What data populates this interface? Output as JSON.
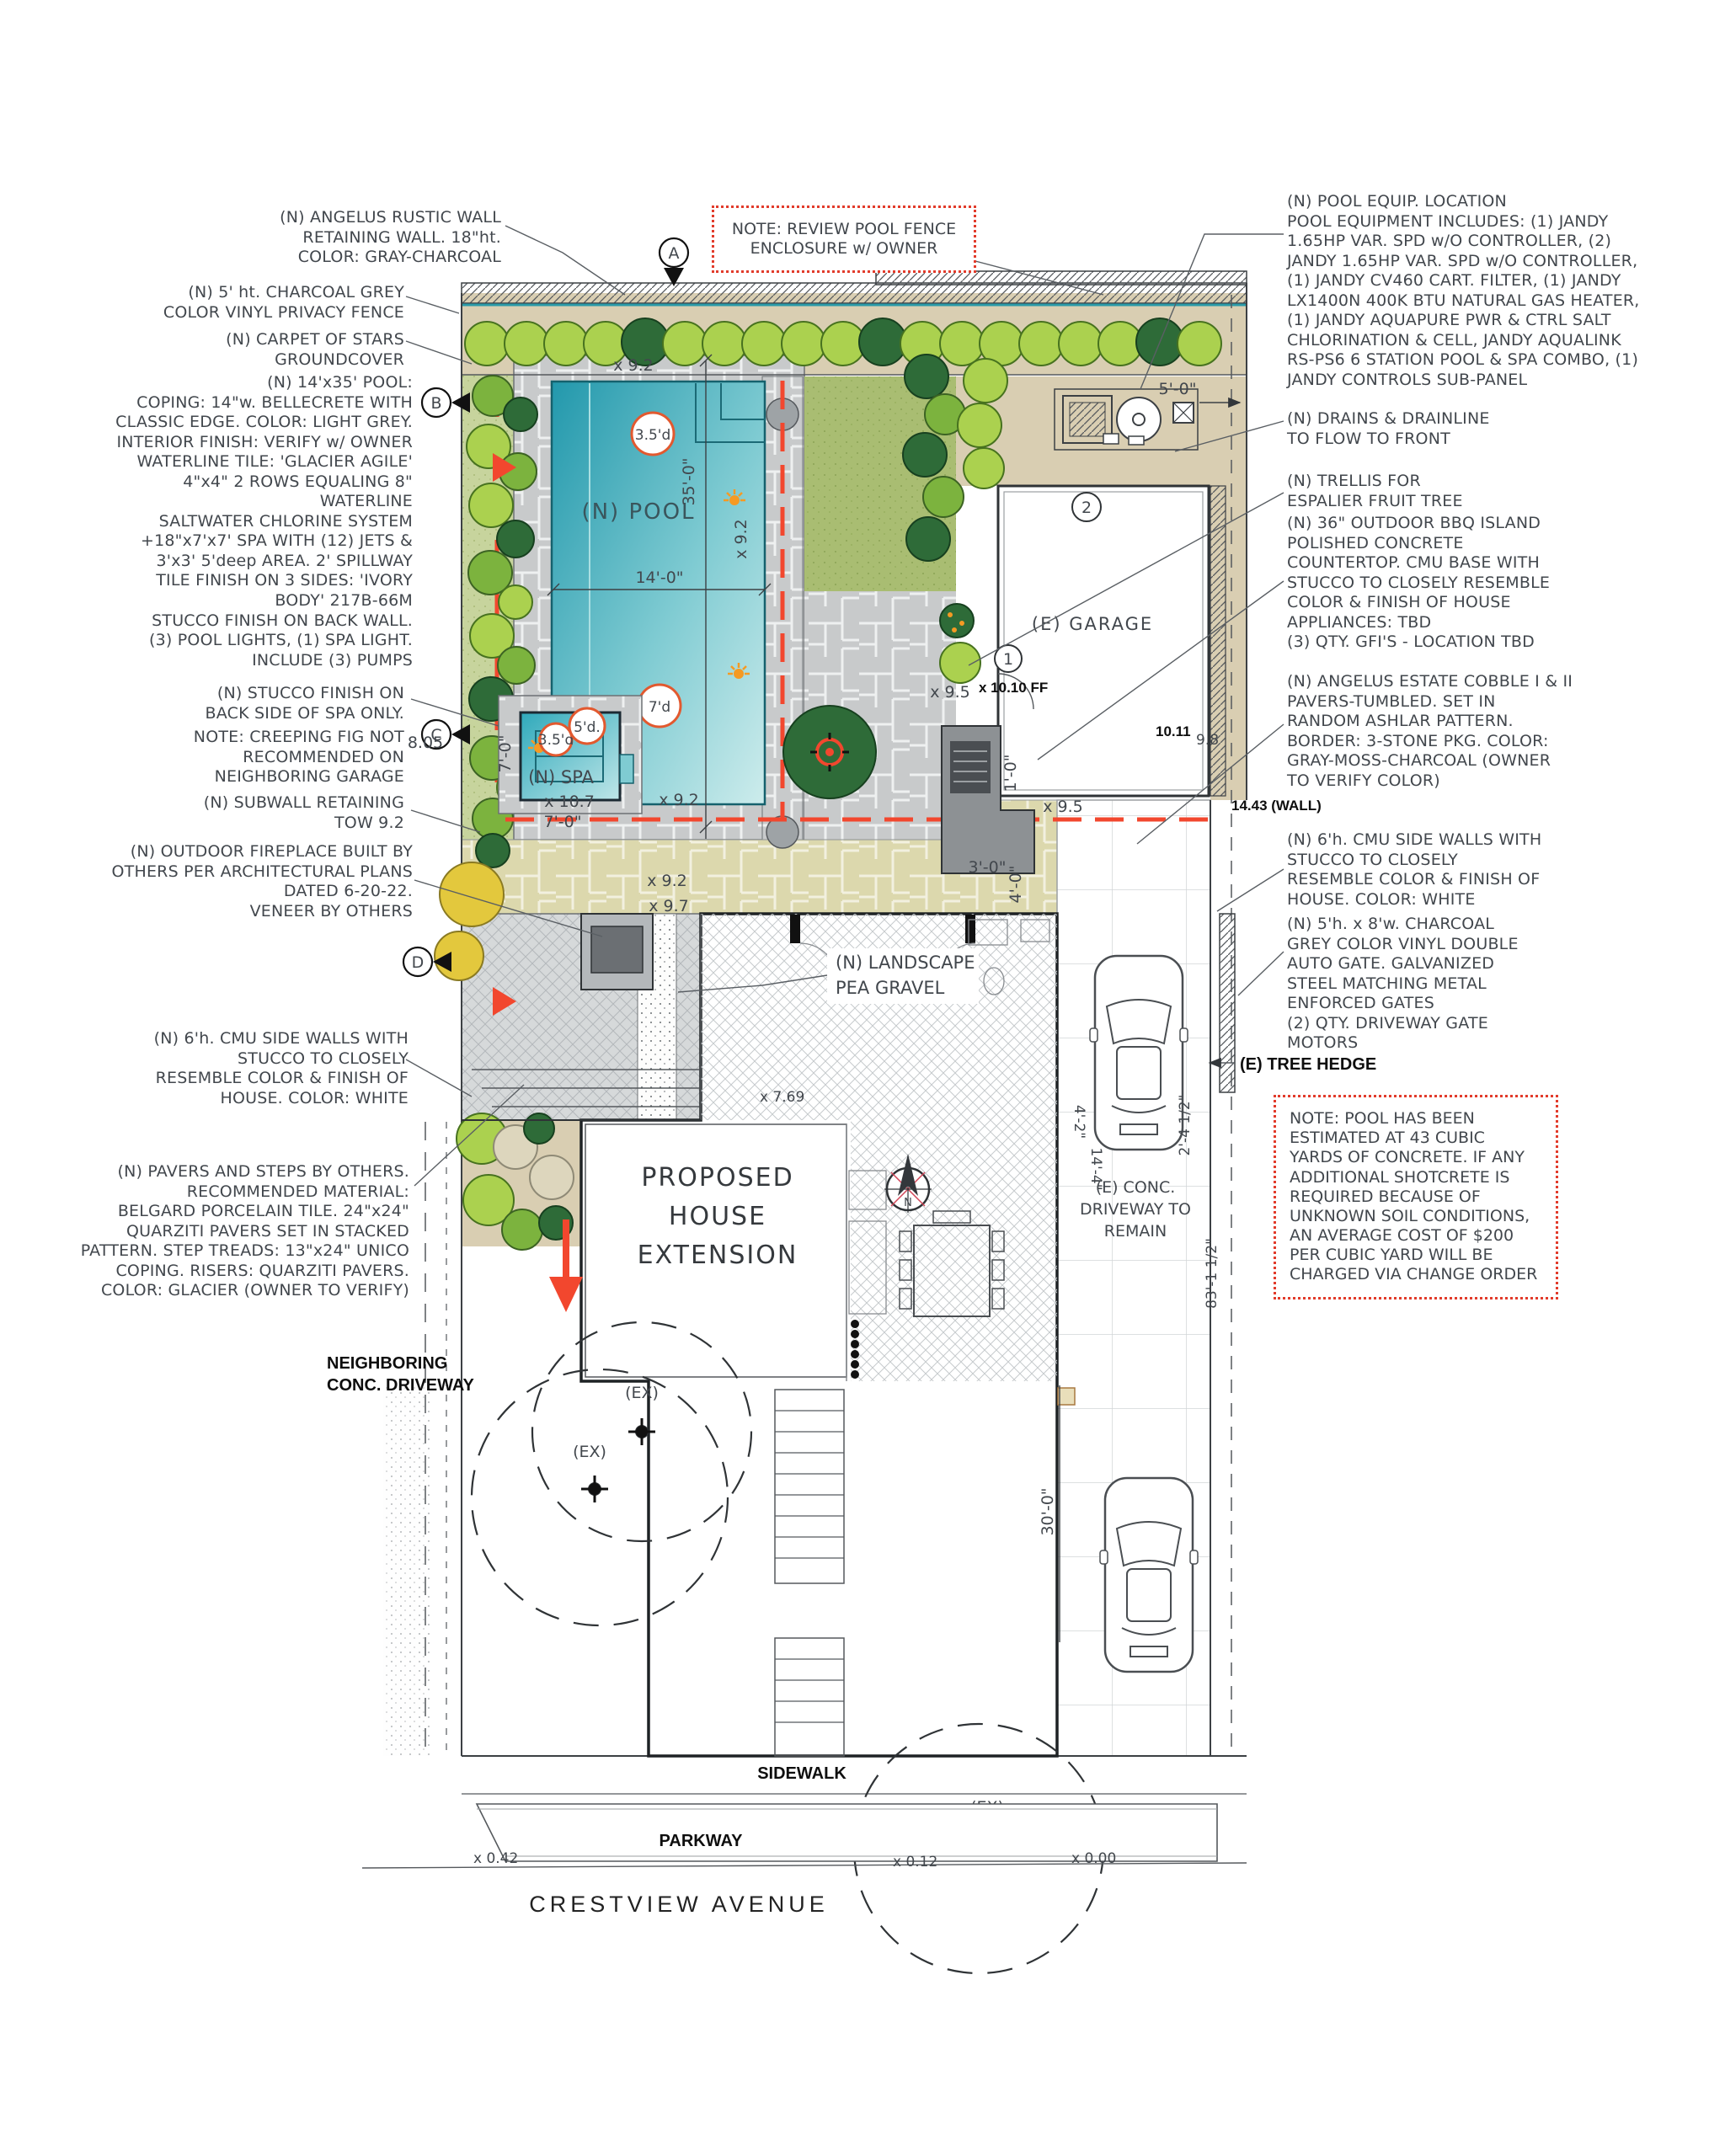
{
  "notes": {
    "top_box": "NOTE: REVIEW POOL FENCE\nENCLOSURE w/ OWNER",
    "left": [
      {
        "text": "(N) ANGELUS RUSTIC WALL\nRETAINING WALL. 18\"ht.\nCOLOR: GRAY-CHARCOAL"
      },
      {
        "text": "(N) 5' ht. CHARCOAL GREY\nCOLOR VINYL  PRIVACY FENCE"
      },
      {
        "text": "(N) CARPET OF STARS\nGROUNDCOVER"
      },
      {
        "text": "(N) 14'x35' POOL:\nCOPING: 14\"w. BELLECRETE WITH\nCLASSIC EDGE.  COLOR: LIGHT GREY.\nINTERIOR FINISH: VERIFY w/ OWNER\nWATERLINE TILE: 'GLACIER AGILE'\n4\"x4\" 2 ROWS EQUALING 8\"\nWATERLINE\nSALTWATER CHLORINE SYSTEM\n+18\"x7'x7' SPA WITH (12) JETS &\n3'x3' 5'deep AREA.  2' SPILLWAY\nTILE FINISH ON 3 SIDES: 'IVORY\nBODY' 217B-66M\nSTUCCO FINISH ON BACK WALL.\n(3) POOL LIGHTS, (1) SPA LIGHT.\nINCLUDE (3) PUMPS"
      },
      {
        "text": "(N) STUCCO FINISH ON\nBACK SIDE OF SPA ONLY."
      },
      {
        "text": "NOTE: CREEPING FIG NOT\nRECOMMENDED ON\nNEIGHBORING GARAGE"
      },
      {
        "text": "(N) SUBWALL RETAINING\nTOW 9.2"
      },
      {
        "text": "(N) OUTDOOR FIREPLACE BUILT BY\nOTHERS PER ARCHITECTURAL PLANS\nDATED 6-20-22.\nVENEER BY OTHERS"
      },
      {
        "text": "(N) 6'h. CMU SIDE WALLS WITH\nSTUCCO TO CLOSELY\nRESEMBLE COLOR & FINISH OF\nHOUSE.  COLOR: WHITE"
      },
      {
        "text": "(N) PAVERS AND STEPS BY OTHERS.\nRECOMMENDED MATERIAL:\nBELGARD PORCELAIN TILE.  24\"x24\"\nQUARZITI PAVERS SET IN STACKED\nPATTERN.  STEP TREADS: 13\"x24\" UNICO\nCOPING.  RISERS: QUARZITI PAVERS.\nCOLOR: GLACIER (OWNER TO VERIFY)"
      },
      {
        "text": "NEIGHBORING\nCONC. DRIVEWAY"
      }
    ],
    "right": [
      {
        "text": "(N) POOL EQUIP. LOCATION\nPOOL EQUIPMENT INCLUDES: (1) JANDY\n1.65HP VAR. SPD w/O CONTROLLER, (2)\nJANDY 1.65HP VAR. SPD w/O CONTROLLER,\n(1) JANDY CV460 CART. FILTER, (1) JANDY\nLX1400N 400K BTU NATURAL GAS HEATER,\n(1) JANDY AQUAPURE PWR & CTRL SALT\nCHLORINATION & CELL, JANDY AQUALINK\nRS-PS6 6 STATION POOL & SPA COMBO, (1)\nJANDY CONTROLS SUB-PANEL"
      },
      {
        "text": "(N) DRAINS & DRAINLINE\nTO FLOW TO FRONT"
      },
      {
        "text": "(N) TRELLIS FOR\nESPALIER FRUIT TREE"
      },
      {
        "text": "(N) 36\" OUTDOOR BBQ ISLAND\nPOLISHED CONCRETE\nCOUNTERTOP. CMU BASE WITH\nSTUCCO TO CLOSELY RESEMBLE\nCOLOR & FINISH OF HOUSE\nAPPLIANCES: TBD\n(3) QTY. GFI'S - LOCATION TBD"
      },
      {
        "text": "(N) ANGELUS ESTATE COBBLE I & II\nPAVERS-TUMBLED.  SET IN\nRANDOM ASHLAR PATTERN.\nBORDER: 3-STONE PKG.  COLOR:\nGRAY-MOSS-CHARCOAL (OWNER\nTO VERIFY COLOR)"
      },
      {
        "text": "(N) 6'h. CMU SIDE WALLS WITH\nSTUCCO TO CLOSELY\nRESEMBLE COLOR & FINISH OF\nHOUSE.  COLOR: WHITE"
      },
      {
        "text": "(N) 5'h. x 8'w. CHARCOAL\nGREY COLOR VINYL DOUBLE\nAUTO GATE. GALVANIZED\nSTEEL MATCHING METAL\nENFORCED GATES\n(2) QTY. DRIVEWAY GATE\nMOTORS"
      }
    ],
    "right_box": "NOTE: POOL HAS BEEN\nESTIMATED AT 43 CUBIC\nYARDS OF CONCRETE. IF ANY\nADDITIONAL SHOTCRETE IS\nREQUIRED BECAUSE OF\nUNKNOWN SOIL CONDITIONS,\nAN AVERAGE COST OF $200\nPER CUBIC YARD WILL BE\nCHARGED VIA CHANGE ORDER"
  },
  "plan": {
    "labels": {
      "pool": "(N) POOL",
      "spa": "(N) SPA",
      "garage": "(E) GARAGE",
      "house1": "PROPOSED",
      "house2": "HOUSE",
      "house3": "EXTENSION",
      "pea1": "(N) LANDSCAPE",
      "pea2": "PEA GRAVEL",
      "drv1": "(E) CONC.",
      "drv2": "DRIVEWAY TO",
      "drv3": "REMAIN",
      "tree_hedge": "(E) TREE HEDGE",
      "sidewalk": "SIDEWALK",
      "parkway": "PARKWAY",
      "street": "CRESTVIEW AVENUE",
      "ex": "(EX)",
      "north": "N",
      "sec_a": "A",
      "sec_b": "B",
      "sec_c": "C",
      "sec_d": "D",
      "key1": "1",
      "key2": "2"
    },
    "depths": {
      "pool_shallow": "3.5'd",
      "pool_deep": "7'd",
      "spa_deep": "5'd.",
      "spa_shallow": "3.5'd"
    },
    "dims": [
      "x 9.2",
      "35'-0\"",
      "14'-0\"",
      "x 9.2",
      "x 10.7",
      "x 9.2",
      "7'-0\"",
      "7'-0\"",
      "x 9.2",
      "x 9.7",
      "x 9.5",
      "x 10.10 FF",
      "5'-0\"",
      "10.11",
      "9.8",
      "14.43 (WALL)",
      "x 9.5",
      "3'-0\"",
      "4'-0\"",
      "1'-0\"",
      "30'-0\"",
      "83'-1 1/2\"",
      "2'-4 1/2\"",
      "4'-2\"",
      "14'-4\"",
      "x 0.42",
      "x 0.12",
      "x 0.00",
      "8.05",
      "x 7.69"
    ],
    "colors": {
      "water": "#2ba4b6",
      "accent_red": "#f2472e",
      "note_red": "#e23b2b",
      "lawn": "#a9bd72",
      "tan": "#d9ceb2",
      "olive_paver": "#dcd8ad",
      "gray_paver": "#c8cacb"
    }
  }
}
